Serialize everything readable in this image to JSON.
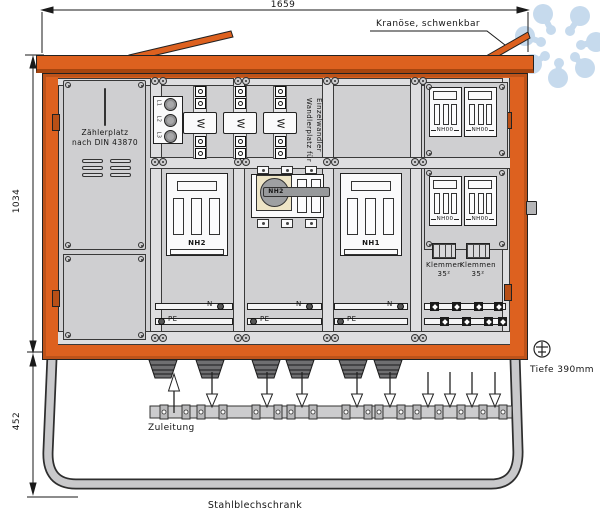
{
  "dimensions": {
    "width": "1659",
    "height": "1034",
    "base": "452",
    "depth": "Tiefe 390mm"
  },
  "labels": {
    "crane": "Kranöse, schwenkbar",
    "supply": "Zuleitung",
    "cabinet": "Stahlblechschrank"
  },
  "meter": {
    "line1": "Zählerplatz",
    "line2": "nach DIN 43870"
  },
  "transformer": {
    "col_left": "Wandlerplatz für",
    "col_right": "Einzelwandler",
    "symbol": "W",
    "phases": [
      "L1",
      "L2",
      "L3"
    ]
  },
  "devices": {
    "nh2_fuse": "NH2",
    "nh2_switch": "NH2",
    "nh1_fuse": "NH1",
    "nh00": [
      "NH00",
      "NH00",
      "NH00",
      "NH00"
    ],
    "klemmen_line1": "Klemmen",
    "klemmen_line2": "35²"
  },
  "bus": {
    "n": "N",
    "pe": "PE"
  },
  "colors": {
    "frame": "#DD611F",
    "watermark": "#C6DAED"
  }
}
